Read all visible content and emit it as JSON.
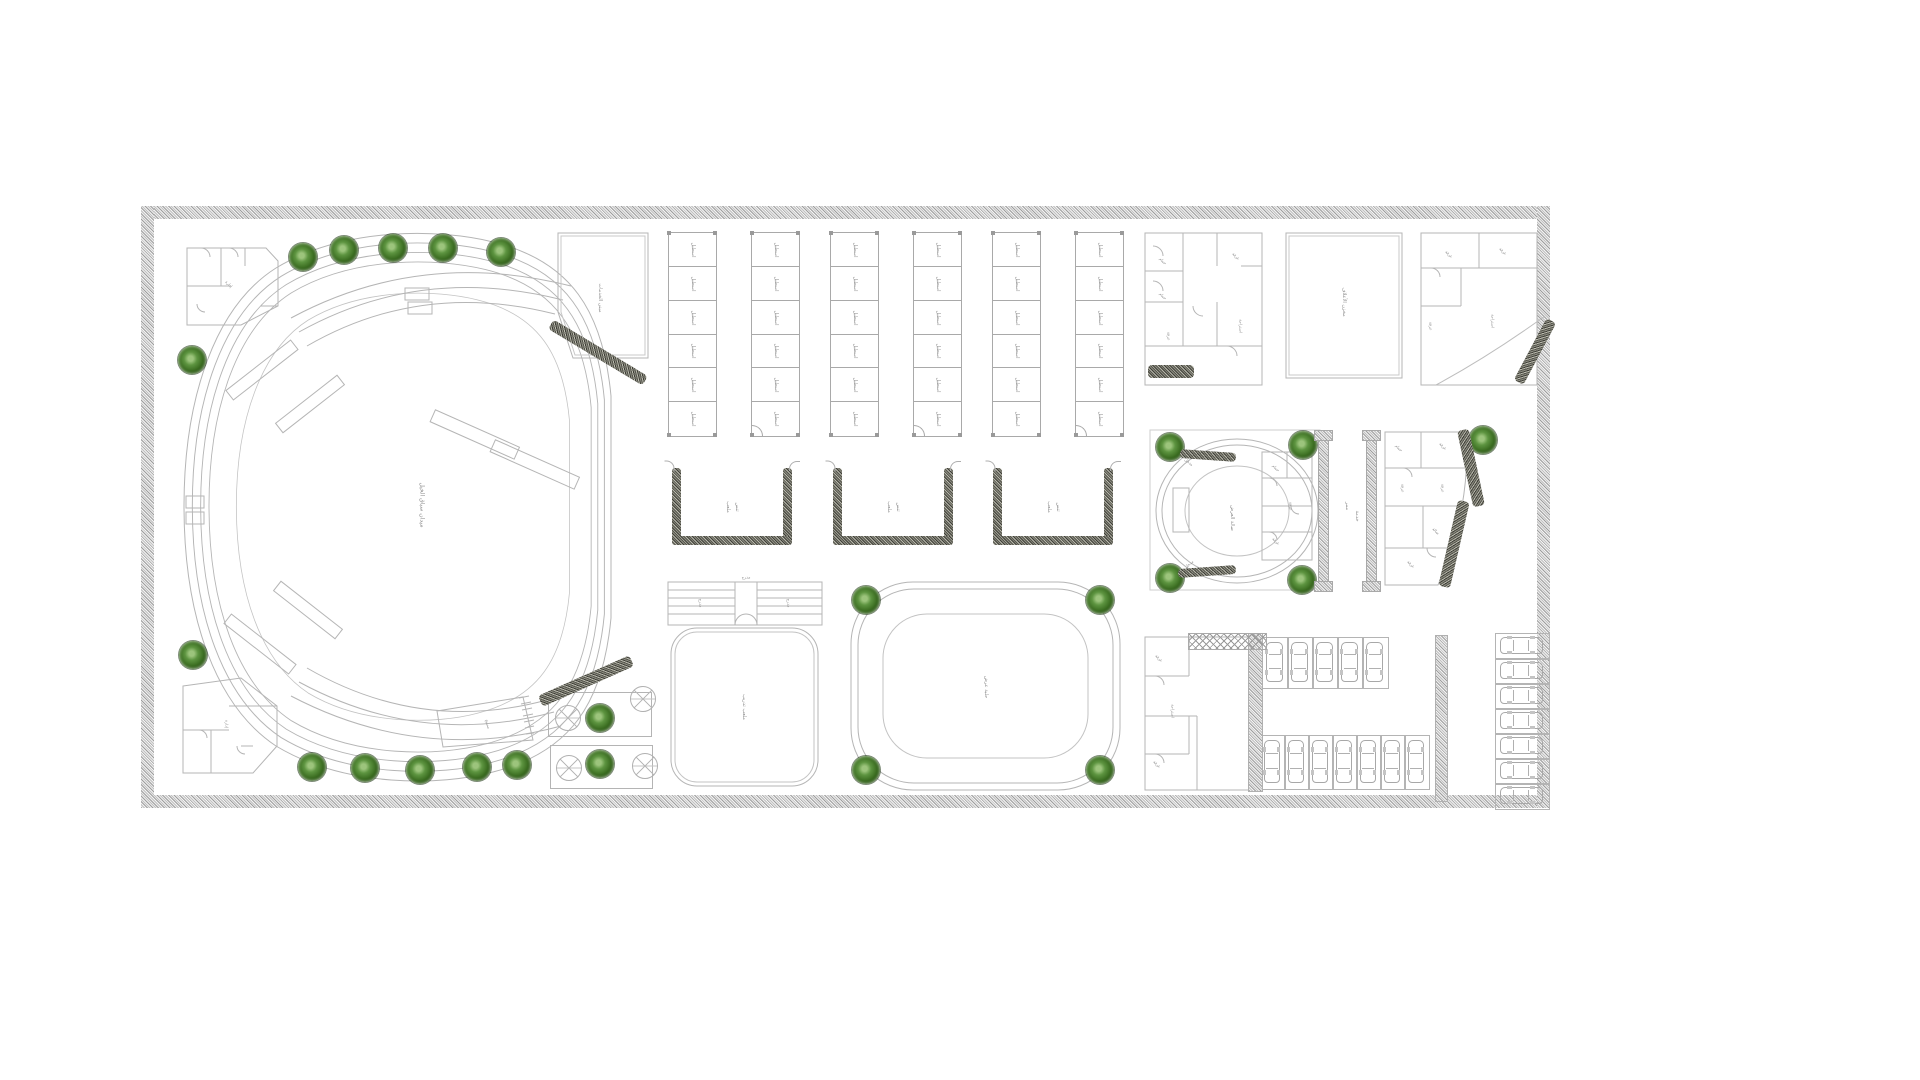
{
  "meta": {
    "drawing_type": "architectural site plan",
    "background": "#ffffff",
    "line_color": "#b5b5b5",
    "wall_color": "#9a9a9a",
    "label_color": "#8f8f8f",
    "tree_green_dark": "#234a11",
    "tree_green_mid": "#5d9440",
    "border_texture": "speckled-stone",
    "plan": {
      "x": 141,
      "y": 206,
      "width": 1409,
      "height": 602,
      "border_thickness": 13
    }
  },
  "labels": {
    "arena": "ميدان سباق الخيل",
    "hall_services": "مبنى الخدمات",
    "stable_room": "اسطبل",
    "tennis_line1": "ملعب",
    "tennis_line2": "تنس",
    "left_court": "ملعب تدريب",
    "grandstand": "مدرج",
    "oval_court": "حلبة عرض",
    "round_hall": "صالة العرض",
    "entrance": "مدخل",
    "corridor1": "ممر",
    "corridor2": "خدمة",
    "feed_store": "مخزن الأعلاف",
    "room": "غرفة",
    "bath": "حمام",
    "office": "إدارة",
    "rest": "استراحة",
    "hall_small": "صالة",
    "pool": "مسبح"
  },
  "trees": {
    "radius": 14,
    "positions": [
      [
        162,
        51
      ],
      [
        203,
        44
      ],
      [
        252,
        42
      ],
      [
        302,
        42
      ],
      [
        360,
        46
      ],
      [
        51,
        154
      ],
      [
        52,
        449
      ],
      [
        171,
        561
      ],
      [
        224,
        562
      ],
      [
        279,
        564
      ],
      [
        336,
        561
      ],
      [
        376,
        559
      ],
      [
        459,
        512
      ],
      [
        459,
        558
      ],
      [
        725,
        394
      ],
      [
        959,
        394
      ],
      [
        725,
        564
      ],
      [
        959,
        564
      ],
      [
        1029,
        241
      ],
      [
        1162,
        239
      ],
      [
        1029,
        372
      ],
      [
        1161,
        374
      ],
      [
        1342,
        234
      ]
    ]
  },
  "stables": {
    "y": 26,
    "height": 203,
    "rows": 6,
    "col_width": 47,
    "col_gap": 36,
    "blocks": [
      {
        "x": 527
      },
      {
        "x": 689
      },
      {
        "x": 851
      }
    ]
  },
  "tennis_courts": {
    "y": 262,
    "width": 120,
    "height": 77,
    "edge": 9,
    "xs": [
      531,
      692,
      852
    ]
  },
  "parking": {
    "row_top": {
      "x": 1121,
      "y": 431,
      "stalls": 5,
      "stall_w": 25,
      "h": 50,
      "dir": "v"
    },
    "row_bottom": {
      "x": 1119,
      "y": 529,
      "stalls": 7,
      "stall_w": 24,
      "h": 53,
      "dir": "v"
    },
    "col_right": {
      "x": 1354,
      "y": 427,
      "stalls": 7,
      "stall_h": 25,
      "w": 53,
      "dir": "h"
    }
  },
  "fountains": {
    "radius": 12,
    "plots": [
      [
        407,
        486,
        102,
        43
      ],
      [
        409,
        539,
        101,
        42
      ]
    ],
    "circles": [
      [
        426,
        511
      ],
      [
        501,
        492
      ],
      [
        427,
        561
      ],
      [
        503,
        559
      ]
    ]
  },
  "hatch_bands": [
    {
      "x": 457,
      "y": 146,
      "len": 110,
      "w": 11,
      "ang": 31
    },
    {
      "x": 445,
      "y": 475,
      "len": 100,
      "w": 12,
      "ang": -24
    },
    {
      "x": 1394,
      "y": 145,
      "len": 70,
      "w": 11,
      "ang": -62
    },
    {
      "x": 1330,
      "y": 262,
      "len": 78,
      "w": 12,
      "ang": 78
    },
    {
      "x": 1313,
      "y": 338,
      "len": 88,
      "w": 12,
      "ang": 103
    },
    {
      "x": 1030,
      "y": 165,
      "len": 46,
      "w": 13,
      "ang": 0
    },
    {
      "x": 1067,
      "y": 249,
      "len": 56,
      "w": 9,
      "ang": 4
    },
    {
      "x": 1066,
      "y": 365,
      "len": 58,
      "w": 9,
      "ang": -4
    }
  ],
  "pilaster_walls": [
    {
      "x": 1177,
      "y": 226,
      "h": 156
    },
    {
      "x": 1225,
      "y": 226,
      "h": 156
    }
  ],
  "strips": [
    {
      "x": 1107,
      "y": 427,
      "w": 13,
      "h": 157
    },
    {
      "x": 1294,
      "y": 429,
      "w": 11,
      "h": 165
    }
  ],
  "floating_labels": [
    {
      "k": "arena",
      "x": 281,
      "y": 299,
      "r": 90,
      "s": 6
    },
    {
      "k": "hall_services",
      "x": 459,
      "y": 92,
      "r": 90,
      "s": 5
    },
    {
      "k": "pool",
      "x": 347,
      "y": 518,
      "r": 75,
      "s": 4
    },
    {
      "k": "left_court",
      "x": 603,
      "y": 501,
      "r": 90,
      "s": 5
    },
    {
      "k": "grandstand",
      "x": 605,
      "y": 371,
      "r": 0,
      "s": 4
    },
    {
      "k": "grandstand",
      "x": 560,
      "y": 397,
      "r": 90,
      "s": 4
    },
    {
      "k": "grandstand",
      "x": 648,
      "y": 397,
      "r": 90,
      "s": 4
    },
    {
      "k": "oval_court",
      "x": 845,
      "y": 481,
      "r": 90,
      "s": 5
    },
    {
      "k": "round_hall",
      "x": 1091,
      "y": 312,
      "r": 90,
      "s": 5
    },
    {
      "k": "entrance",
      "x": 1048,
      "y": 256,
      "r": 40,
      "s": 4
    },
    {
      "k": "entrance",
      "x": 1048,
      "y": 358,
      "r": -40,
      "s": 4
    },
    {
      "k": "corridor1",
      "x": 1206,
      "y": 300,
      "r": 90,
      "s": 5
    },
    {
      "k": "corridor2",
      "x": 1216,
      "y": 310,
      "r": 90,
      "s": 5
    },
    {
      "k": "feed_store",
      "x": 1203,
      "y": 96,
      "r": 90,
      "s": 5
    },
    {
      "k": "bath",
      "x": 1022,
      "y": 55,
      "r": 45,
      "s": 4
    },
    {
      "k": "bath",
      "x": 1022,
      "y": 90,
      "r": 45,
      "s": 4
    },
    {
      "k": "room",
      "x": 1095,
      "y": 50,
      "r": 45,
      "s": 4
    },
    {
      "k": "rest",
      "x": 1100,
      "y": 120,
      "r": 90,
      "s": 4
    },
    {
      "k": "room",
      "x": 1028,
      "y": 130,
      "r": 90,
      "s": 4
    },
    {
      "k": "room",
      "x": 1308,
      "y": 48,
      "r": 45,
      "s": 4
    },
    {
      "k": "room",
      "x": 1362,
      "y": 45,
      "r": 45,
      "s": 4
    },
    {
      "k": "rest",
      "x": 1352,
      "y": 115,
      "r": 90,
      "s": 4
    },
    {
      "k": "room",
      "x": 1290,
      "y": 120,
      "r": 90,
      "s": 4
    },
    {
      "k": "bath",
      "x": 1258,
      "y": 242,
      "r": 45,
      "s": 4
    },
    {
      "k": "room",
      "x": 1302,
      "y": 240,
      "r": 45,
      "s": 4
    },
    {
      "k": "room",
      "x": 1262,
      "y": 282,
      "r": 90,
      "s": 4
    },
    {
      "k": "room",
      "x": 1302,
      "y": 282,
      "r": 90,
      "s": 4
    },
    {
      "k": "hall_small",
      "x": 1295,
      "y": 325,
      "r": 45,
      "s": 4
    },
    {
      "k": "room",
      "x": 1270,
      "y": 358,
      "r": 45,
      "s": 4
    },
    {
      "k": "bath",
      "x": 1135,
      "y": 262,
      "r": 45,
      "s": 4
    },
    {
      "k": "room",
      "x": 1150,
      "y": 300,
      "r": 90,
      "s": 4
    },
    {
      "k": "room",
      "x": 1135,
      "y": 335,
      "r": 45,
      "s": 4
    },
    {
      "k": "room",
      "x": 1018,
      "y": 452,
      "r": 45,
      "s": 4
    },
    {
      "k": "rest",
      "x": 1032,
      "y": 505,
      "r": 90,
      "s": 4
    },
    {
      "k": "room",
      "x": 1016,
      "y": 558,
      "r": 45,
      "s": 4
    },
    {
      "k": "office",
      "x": 88,
      "y": 78,
      "r": 45,
      "s": 4
    },
    {
      "k": "office",
      "x": 86,
      "y": 518,
      "r": 90,
      "s": 4
    }
  ]
}
